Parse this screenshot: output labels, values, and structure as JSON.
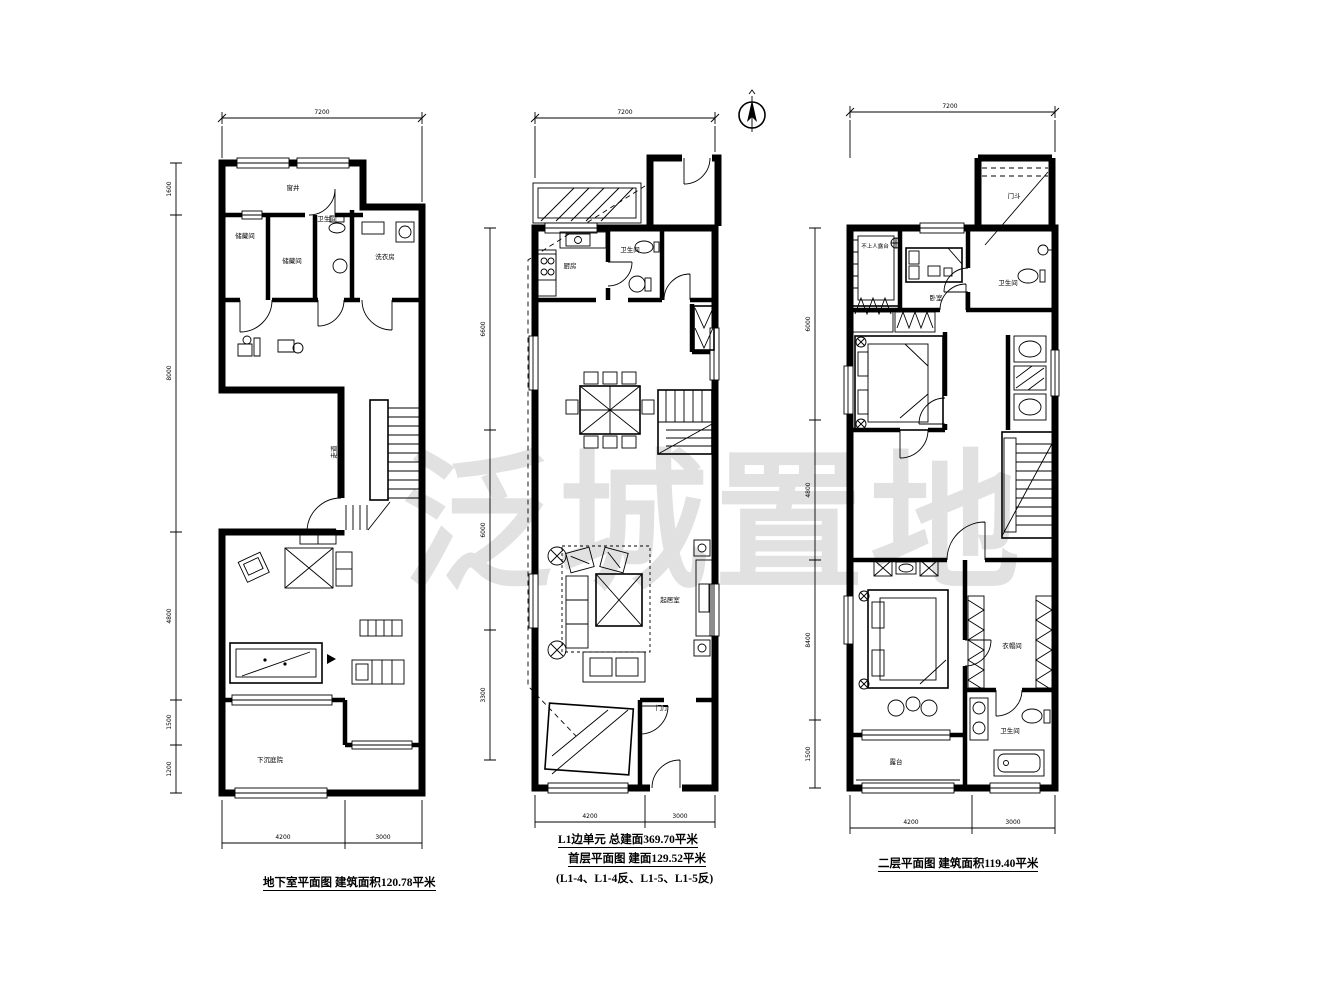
{
  "watermark": {
    "text": "泛城置地",
    "color": "#c9c9c9"
  },
  "compass": {
    "name": "north-indicator"
  },
  "plans": {
    "basement": {
      "caption": "地下室平面图 建筑面积120.78平米",
      "rooms": {
        "window_well": "窗井",
        "storage_1": "储藏间",
        "storage_2": "储藏间",
        "bathroom": "卫生间",
        "laundry": "洗衣房",
        "corridor": "走道",
        "sunken_courtyard": "下沉庭院"
      },
      "dims": {
        "top": "7200",
        "left": [
          "1600",
          "8000",
          "4800",
          "1500",
          "1200"
        ],
        "bottom": [
          "4200",
          "3000"
        ]
      }
    },
    "first_floor": {
      "caption_line1": "L1边单元 总建面369.70平米",
      "caption_line2": "首层平面图 建面129.52平米",
      "caption_line3": "(L1-4、L1-4反、L1-5、L1-5反)",
      "rooms": {
        "kitchen": "厨房",
        "bathroom": "卫生间",
        "living_room": "起居室",
        "foyer": "门厅"
      },
      "dims": {
        "top": "7200",
        "left": [
          "6600",
          "6000",
          "3300"
        ],
        "bottom": [
          "4200",
          "3000"
        ]
      }
    },
    "second_floor": {
      "caption": "二层平面图 建筑面积119.40平米",
      "rooms": {
        "roof_terrace": "不上人露台",
        "bedroom": "卧室",
        "bathroom_top": "卫生间",
        "canopy": "门斗",
        "closet": "衣帽间",
        "bathroom_bottom": "卫生间",
        "terrace": "露台"
      },
      "dims": {
        "top": "7200",
        "left": [
          "6000",
          "4800",
          "8400",
          "1500"
        ],
        "bottom": [
          "4200",
          "3000"
        ]
      }
    }
  }
}
